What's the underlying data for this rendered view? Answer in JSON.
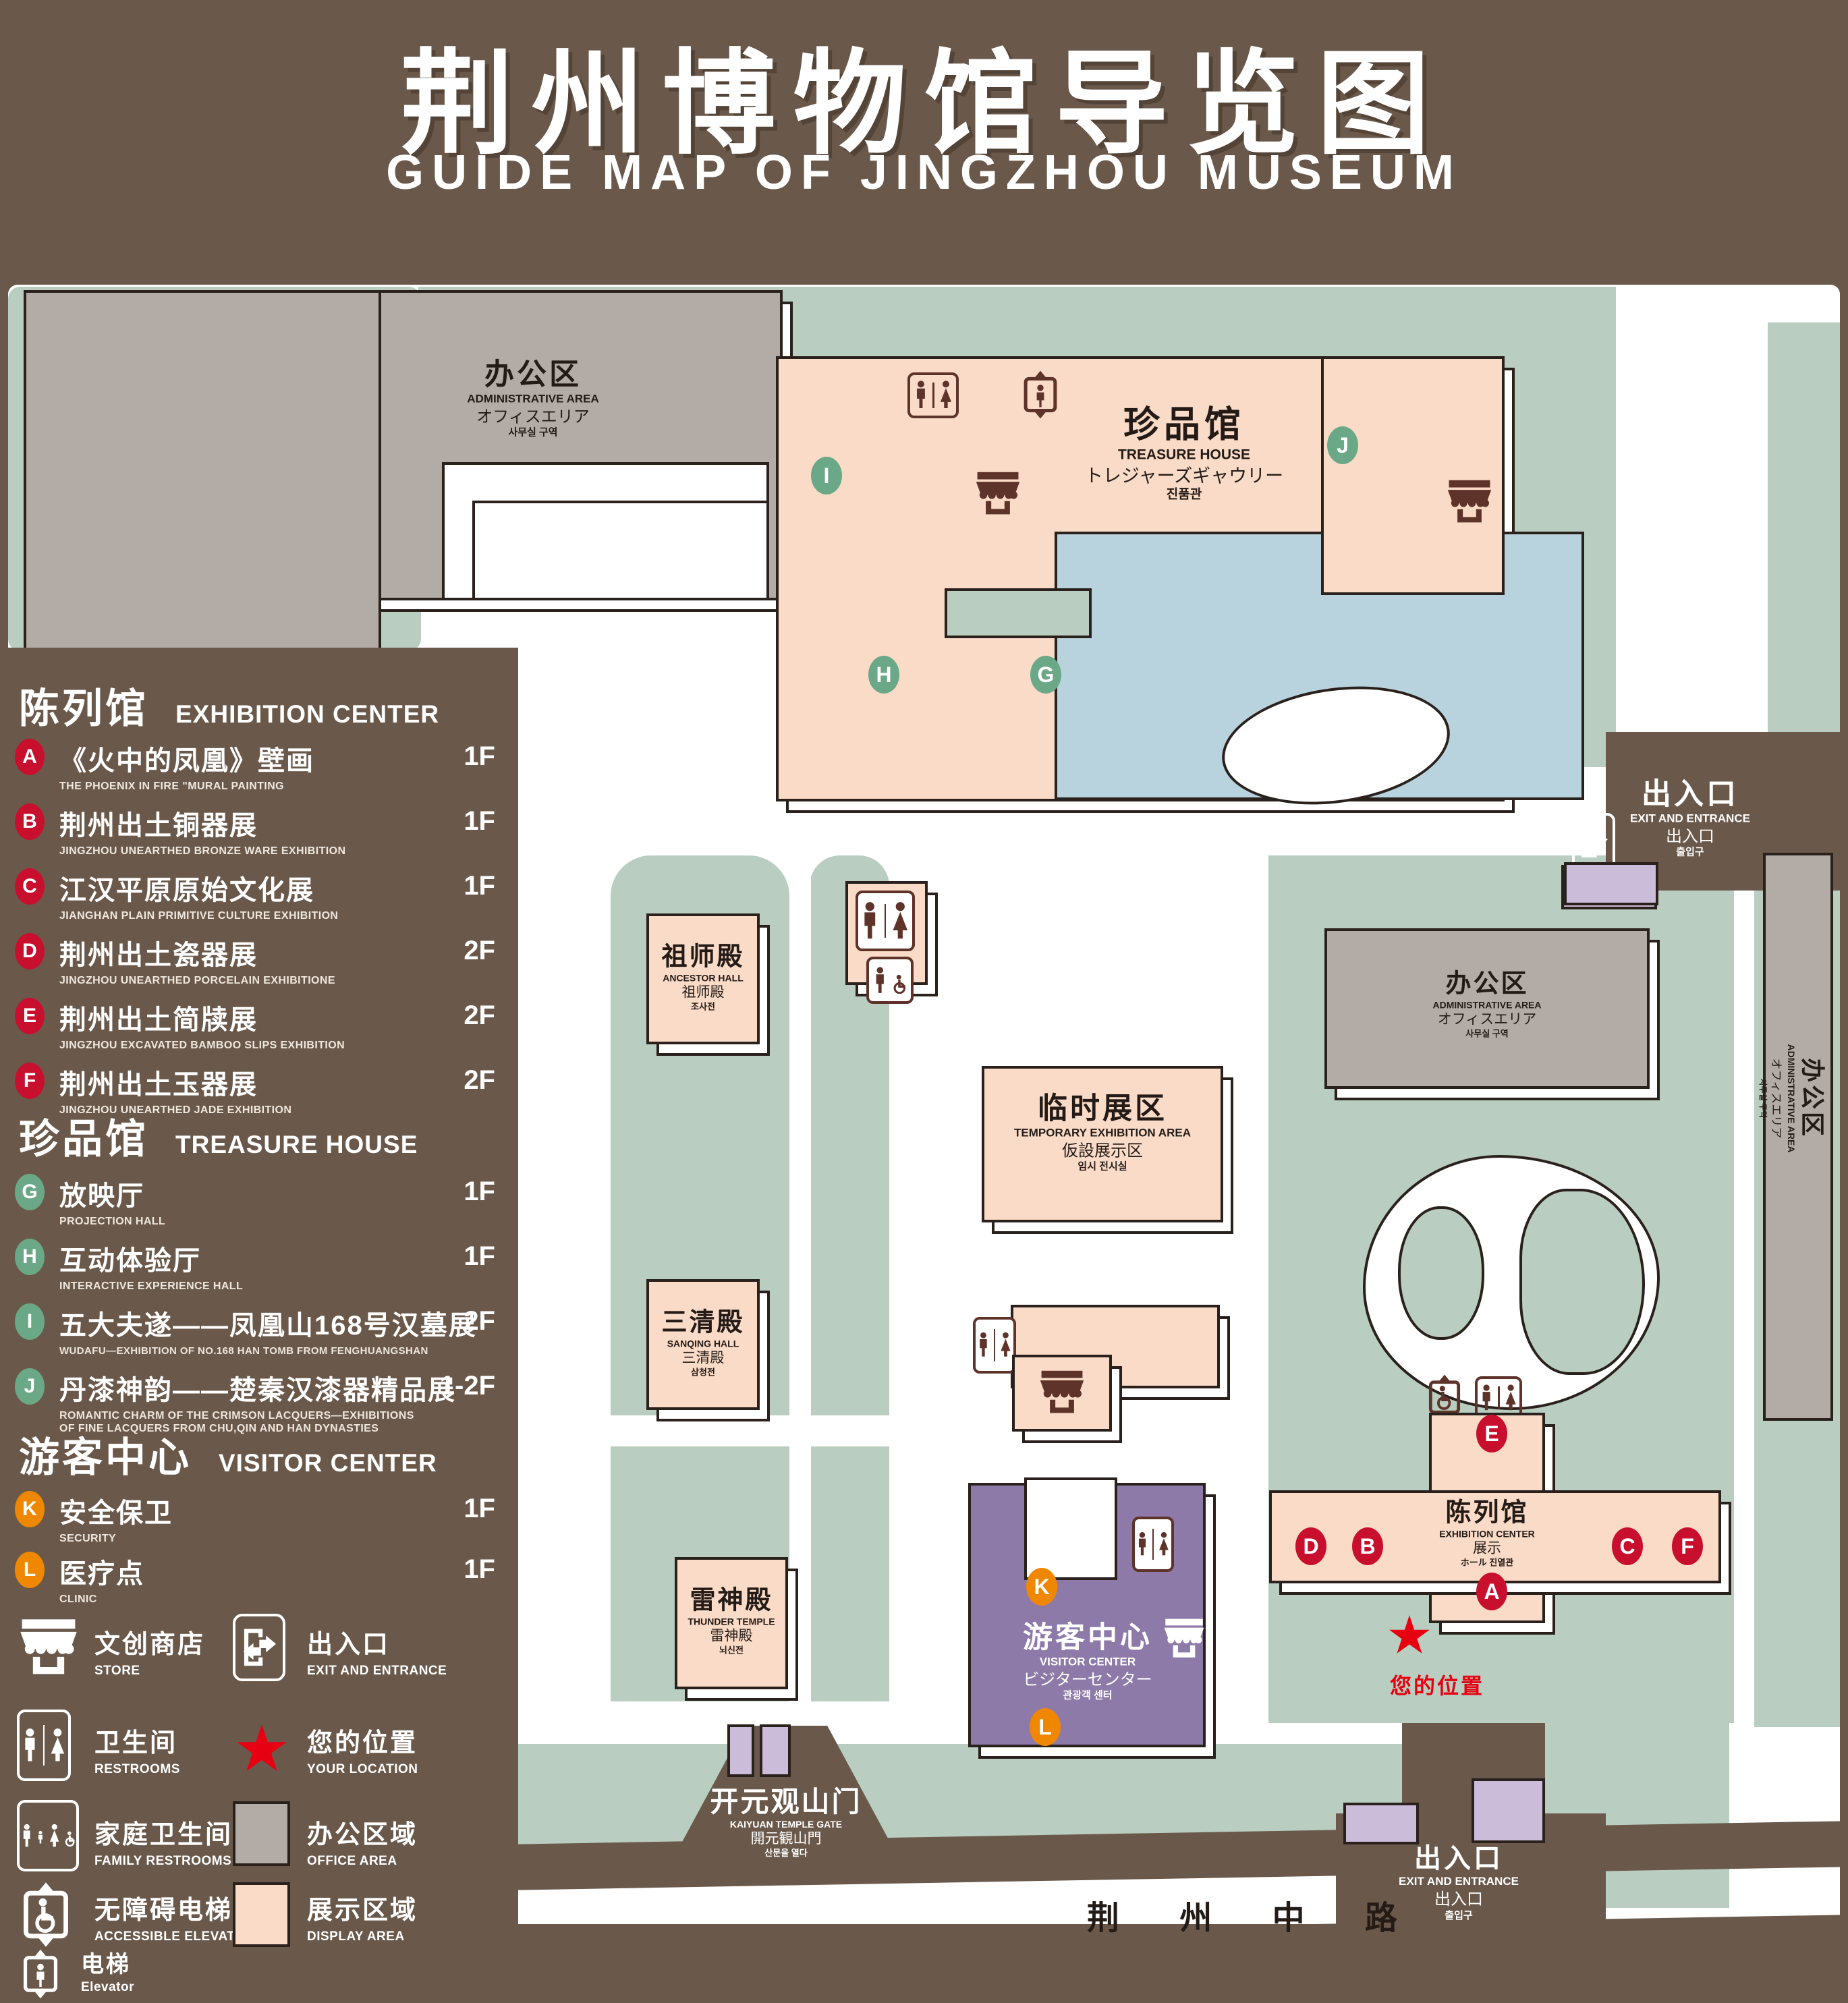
{
  "title": {
    "zh": "荆州博物馆导览图",
    "en": "GUIDE MAP OF JINGZHOU MUSEUM"
  },
  "legend": {
    "sections": [
      {
        "zh": "陈列馆",
        "en": "EXHIBITION CENTER",
        "items": [
          {
            "key": "A",
            "zh": "《火中的凤凰》壁画",
            "en": "THE PHOENIX IN FIRE \"MURAL PAINTING",
            "floor": "1F"
          },
          {
            "key": "B",
            "zh": "荆州出土铜器展",
            "en": "JINGZHOU UNEARTHED BRONZE WARE EXHIBITION",
            "floor": "1F"
          },
          {
            "key": "C",
            "zh": "江汉平原原始文化展",
            "en": "JIANGHAN PLAIN PRIMITIVE CULTURE EXHIBITION",
            "floor": "1F"
          },
          {
            "key": "D",
            "zh": "荆州出土瓷器展",
            "en": "JINGZHOU UNEARTHED PORCELAIN EXHIBITIONE",
            "floor": "2F"
          },
          {
            "key": "E",
            "zh": "荆州出土简牍展",
            "en": "JINGZHOU EXCAVATED BAMBOO SLIPS EXHIBITION",
            "floor": "2F"
          },
          {
            "key": "F",
            "zh": "荆州出土玉器展",
            "en": "JINGZHOU UNEARTHED JADE EXHIBITION",
            "floor": "2F"
          }
        ]
      },
      {
        "zh": "珍品馆",
        "en": "TREASURE HOUSE",
        "items": [
          {
            "key": "G",
            "zh": "放映厅",
            "en": "PROJECTION HALL",
            "floor": "1F"
          },
          {
            "key": "H",
            "zh": "互动体验厅",
            "en": "INTERACTIVE EXPERIENCE HALL",
            "floor": "1F"
          },
          {
            "key": "I",
            "zh": "五大夫遂——凤凰山168号汉墓展",
            "en": "WUDAFU—EXHIBITION OF NO.168 HAN TOMB FROM FENGHUANGSHAN",
            "floor": "2F"
          },
          {
            "key": "J",
            "zh": "丹漆神韵——楚秦汉漆器精品展",
            "en": "ROMANTIC CHARM OF THE CRIMSON LACQUERS—EXHIBITIONS",
            "en2": "OF FINE LACQUERS FROM CHU,QIN AND HAN DYNASTIES",
            "floor": "1-2F"
          }
        ]
      },
      {
        "zh": "游客中心",
        "en": "VISITOR CENTER",
        "items": [
          {
            "key": "K",
            "zh": "安全保卫",
            "en": "SECURITY",
            "floor": "1F"
          },
          {
            "key": "L",
            "zh": "医疗点",
            "en": "CLINIC",
            "floor": "1F"
          }
        ]
      }
    ],
    "symbols": {
      "store": {
        "zh": "文创商店",
        "en": "STORE"
      },
      "exit": {
        "zh": "出入口",
        "en": "EXIT AND ENTRANCE"
      },
      "restrooms": {
        "zh": "卫生间",
        "en": "RESTROOMS"
      },
      "location": {
        "zh": "您的位置",
        "en": "YOUR LOCATION"
      },
      "family": {
        "zh": "家庭卫生间",
        "en": "FAMILY RESTROOMS"
      },
      "office": {
        "zh": "办公区域",
        "en": "OFFICE AREA"
      },
      "accessible": {
        "zh": "无障碍电梯",
        "en": "ACCESSIBLE ELEVATOR"
      },
      "display": {
        "zh": "展示区域",
        "en": "DISPLAY AREA"
      },
      "elevator": {
        "zh": "电梯",
        "en": "Elevator"
      }
    }
  },
  "map": {
    "admin": {
      "zh": "办公区",
      "en": "ADMINISTRATIVE AREA",
      "jp": "オフィスエリア",
      "kr": "사무실 구역"
    },
    "treasure": {
      "zh": "珍品馆",
      "en": "TREASURE HOUSE",
      "jp": "トレジャーズギャウリー",
      "kr": "진품관"
    },
    "ancestor": {
      "zh": "祖师殿",
      "en": "ANCESTOR HALL",
      "jp": "祖师殿",
      "kr": "조사전"
    },
    "sanqing": {
      "zh": "三清殿",
      "en": "SANQING HALL",
      "jp": "三清殿",
      "kr": "삼청전"
    },
    "thunder": {
      "zh": "雷神殿",
      "en": "THUNDER TEMPLE",
      "jp": "雷神殿",
      "kr": "뇌신전"
    },
    "temporary": {
      "zh": "临时展区",
      "en": "TEMPORARY EXHIBITION AREA",
      "jp": "仮設展示区",
      "kr": "임시 전시실"
    },
    "visitor": {
      "zh": "游客中心",
      "en": "VISITOR CENTER",
      "jp": "ビジターセンター",
      "kr": "관광객 센터"
    },
    "exhibition": {
      "zh": "陈列馆",
      "en": "EXHIBITION CENTER",
      "jp": "展示",
      "jp2": "ホール 진열관"
    },
    "exit": {
      "zh": "出入口",
      "en": "EXIT AND ENTRANCE",
      "zh2": "出入口",
      "kr": "출입구"
    },
    "gate": {
      "zh": "开元观山门",
      "en": "KAIYUAN TEMPLE GATE",
      "jp": "開元観山門",
      "kr": "산문을 열다"
    },
    "road": "荆 州 中 路",
    "your_location": "您的位置",
    "markers": {
      "a": "A",
      "b": "B",
      "c": "C",
      "d": "D",
      "e": "E",
      "f": "F",
      "g": "G",
      "h": "H",
      "i": "I",
      "j": "J",
      "k": "K",
      "l": "L"
    }
  },
  "colors": {
    "background_brown": "#6a594b",
    "ground_green": "#b9cec0",
    "display_area_pink": "#f9dbc7",
    "office_area_gray": "#b3aca6",
    "visitor_purple": "#8d7aa9",
    "water_blue": "#b9d3de",
    "badge_red": "#c8102e",
    "badge_green": "#6aa887",
    "badge_orange": "#f08700",
    "star_red": "#e60012",
    "icon_maroon": "#5e332a"
  }
}
